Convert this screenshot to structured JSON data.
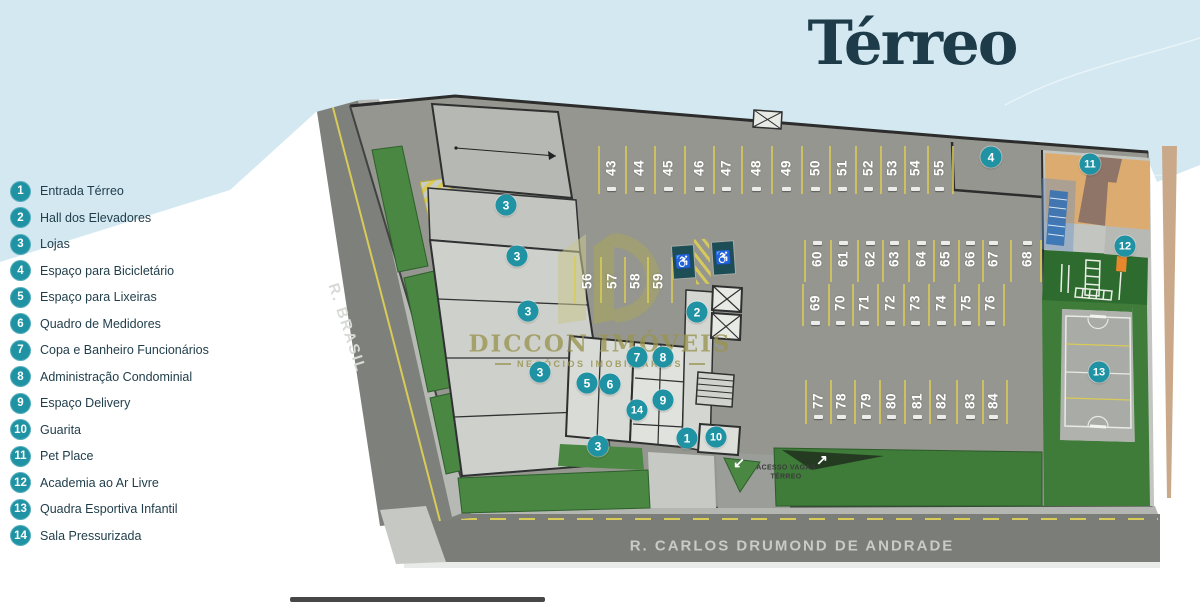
{
  "title": "Térreo",
  "legend": [
    {
      "num": "1",
      "label": "Entrada Térreo"
    },
    {
      "num": "2",
      "label": "Hall dos Elevadores"
    },
    {
      "num": "3",
      "label": "Lojas"
    },
    {
      "num": "4",
      "label": "Espaço para Bicicletário"
    },
    {
      "num": "5",
      "label": "Espaço para Lixeiras"
    },
    {
      "num": "6",
      "label": "Quadro de Medidores"
    },
    {
      "num": "7",
      "label": "Copa e Banheiro Funcionários"
    },
    {
      "num": "8",
      "label": "Administração Condominial"
    },
    {
      "num": "9",
      "label": "Espaço Delivery"
    },
    {
      "num": "10",
      "label": "Guarita"
    },
    {
      "num": "11",
      "label": "Pet Place"
    },
    {
      "num": "12",
      "label": "Academia ao Ar Livre"
    },
    {
      "num": "13",
      "label": "Quadra Esportiva Infantil"
    },
    {
      "num": "14",
      "label": "Sala Pressurizada"
    }
  ],
  "plan": {
    "street_left": "R. BRASIL",
    "street_bottom": "R. CARLOS DRUMOND DE ANDRADE",
    "access_line1": "ACESSO VAGAS",
    "access_line2": "TÉRREO",
    "parking_rows": {
      "top": [
        "43",
        "44",
        "45",
        "46",
        "47",
        "48",
        "49",
        "50",
        "51",
        "52",
        "53",
        "54",
        "55"
      ],
      "visitors": [
        "56",
        "57",
        "58",
        "59"
      ],
      "mid_a": [
        "60",
        "61",
        "62",
        "63",
        "64",
        "65",
        "66",
        "67",
        "68"
      ],
      "mid_b": [
        "69",
        "70",
        "71",
        "72",
        "73",
        "74",
        "75",
        "76"
      ],
      "bottom": [
        "77",
        "78",
        "79",
        "80",
        "81",
        "82",
        "83",
        "84"
      ]
    },
    "markers": [
      {
        "n": "1",
        "x": 687,
        "y": 438
      },
      {
        "n": "2",
        "x": 697,
        "y": 312
      },
      {
        "n": "3",
        "x": 506,
        "y": 205
      },
      {
        "n": "3",
        "x": 517,
        "y": 256
      },
      {
        "n": "3",
        "x": 528,
        "y": 311
      },
      {
        "n": "3",
        "x": 540,
        "y": 372
      },
      {
        "n": "3",
        "x": 598,
        "y": 446
      },
      {
        "n": "4",
        "x": 991,
        "y": 157
      },
      {
        "n": "5",
        "x": 587,
        "y": 383
      },
      {
        "n": "6",
        "x": 610,
        "y": 384
      },
      {
        "n": "7",
        "x": 637,
        "y": 357
      },
      {
        "n": "8",
        "x": 663,
        "y": 357
      },
      {
        "n": "9",
        "x": 663,
        "y": 400
      },
      {
        "n": "10",
        "x": 716,
        "y": 437
      },
      {
        "n": "11",
        "x": 1090,
        "y": 164
      },
      {
        "n": "12",
        "x": 1125,
        "y": 246
      },
      {
        "n": "13",
        "x": 1099,
        "y": 372
      },
      {
        "n": "14",
        "x": 637,
        "y": 410
      }
    ]
  },
  "icons": {
    "wheelchair": "♿",
    "arrow_down_left": "↙",
    "arrow_up_right": "↗"
  },
  "watermark": {
    "brand": "DICCON IMÓVEIS",
    "tagline": "NEGÓCIOS IMOBILIÁRIOS"
  },
  "colors": {
    "accent_teal": "#1f93a4",
    "title": "#1d3b48",
    "sky": "#d3e8f1",
    "handicap_bg": "#1d4d55"
  }
}
